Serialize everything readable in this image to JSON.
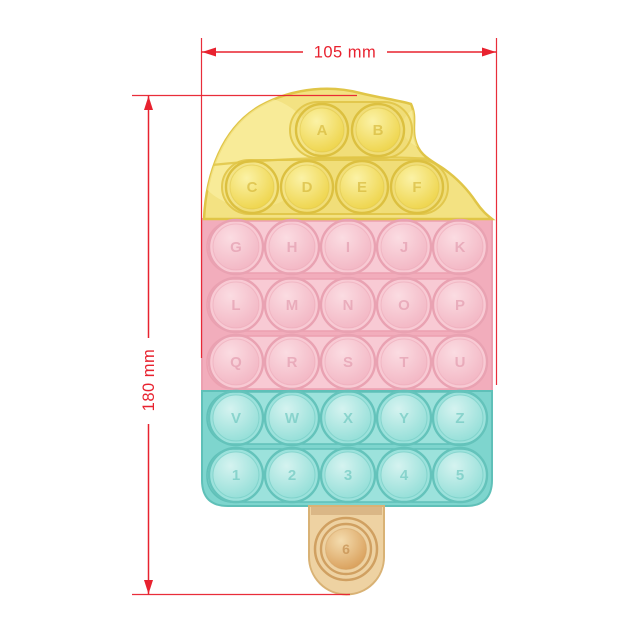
{
  "dimensions": {
    "accent_color": "#e8222f",
    "width": {
      "label": "105 mm"
    },
    "height": {
      "label": "180 mm"
    }
  },
  "toy": {
    "rows": [
      {
        "section": "yellow",
        "labels": [
          "A",
          "B"
        ]
      },
      {
        "section": "yellow",
        "labels": [
          "C",
          "D",
          "E",
          "F"
        ]
      },
      {
        "section": "pink",
        "labels": [
          "G",
          "H",
          "I",
          "J",
          "K"
        ]
      },
      {
        "section": "pink",
        "labels": [
          "L",
          "M",
          "N",
          "O",
          "P"
        ]
      },
      {
        "section": "pink",
        "labels": [
          "Q",
          "R",
          "S",
          "T",
          "U"
        ]
      },
      {
        "section": "teal",
        "labels": [
          "V",
          "W",
          "X",
          "Y",
          "Z"
        ]
      },
      {
        "section": "teal",
        "labels": [
          "1",
          "2",
          "3",
          "4",
          "5"
        ]
      },
      {
        "section": "stick",
        "labels": [
          "6"
        ]
      }
    ],
    "palette": {
      "yellow": {
        "base": "#f3e282",
        "pocket": "#eed868",
        "hi": "#fbf2a6",
        "lo": "#edd245",
        "edge": "#e0c547",
        "ring": "#dcc040",
        "letter": "#d2b230"
      },
      "pink": {
        "base": "#f2adbc",
        "strip": "#f8cad4",
        "hi": "#fbdce2",
        "lo": "#f2b4c2",
        "edge": "#eca0b0",
        "ring": "#e9a2b2",
        "letter": "#e095a9"
      },
      "teal": {
        "base": "#7ed5ce",
        "strip": "#9ce2dc",
        "hi": "#d5f3f0",
        "lo": "#8fddd6",
        "edge": "#5fc0b8",
        "ring": "#64c3bb",
        "letter": "#63c3ba"
      },
      "stick": {
        "base": "#eed2a2",
        "shadow": "#c19663",
        "hi": "#f4dcae",
        "lo": "#d79b55",
        "edge": "#d9b275",
        "ring": "#d0a061",
        "letter": "#bd8443"
      }
    }
  }
}
